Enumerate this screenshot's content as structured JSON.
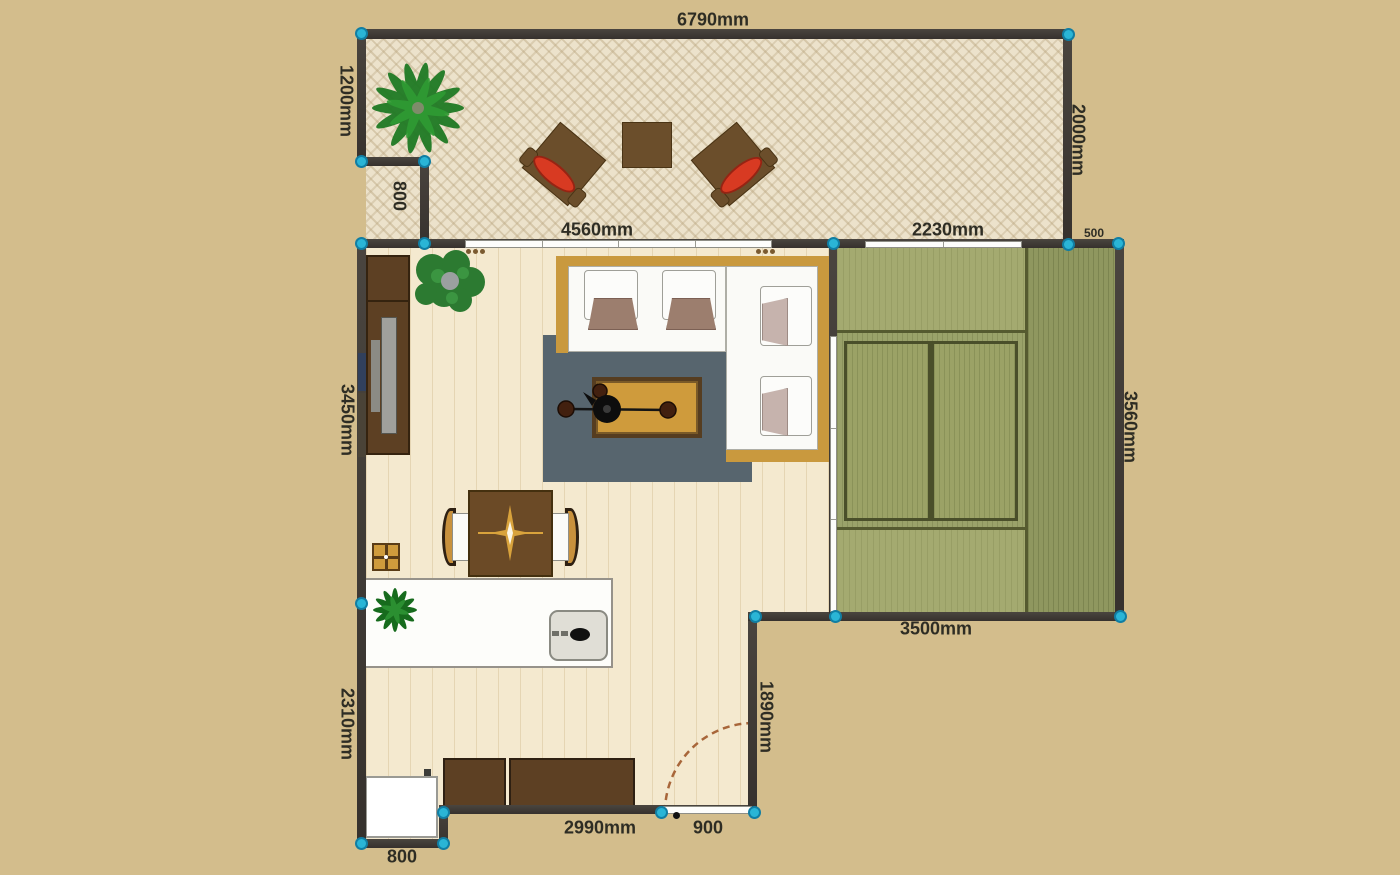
{
  "app": {
    "view": "2d-floor-plan"
  },
  "dimension_labels": {
    "top_width": "6790mm",
    "terrace_left_height": "1200mm",
    "terrace_right_height": "2000mm",
    "terrace_step_height": "800",
    "living_top_width": "4560mm",
    "tatami_window_width": "2230mm",
    "tatami_offset": "500",
    "living_left_upper": "3450mm",
    "tatami_right_height": "3560mm",
    "tatami_bottom_width": "3500mm",
    "living_left_lower": "2310mm",
    "living_right_lower": "1890mm",
    "bottom_wall_width": "2990mm",
    "door_width": "900",
    "alcove_width": "800"
  },
  "colors": {
    "background": "#d3bd8c",
    "wall": "#3f3a35",
    "control_point": "#2ab5d6",
    "terrace_floor": "#ece2cb",
    "wood_floor": "#f4e9cf",
    "tatami_green": "#9aa26a",
    "tatami_border": "#4a4f2a",
    "rug": "#57656e",
    "sofa_frame": "#c9993e",
    "furniture_brown": "#5d4023",
    "cushion_red": "#d83a22",
    "dimension_text": "#2e2d24"
  },
  "icons": {
    "control_points": "corner-drag-handles",
    "door_swing": "dashed-arc"
  }
}
